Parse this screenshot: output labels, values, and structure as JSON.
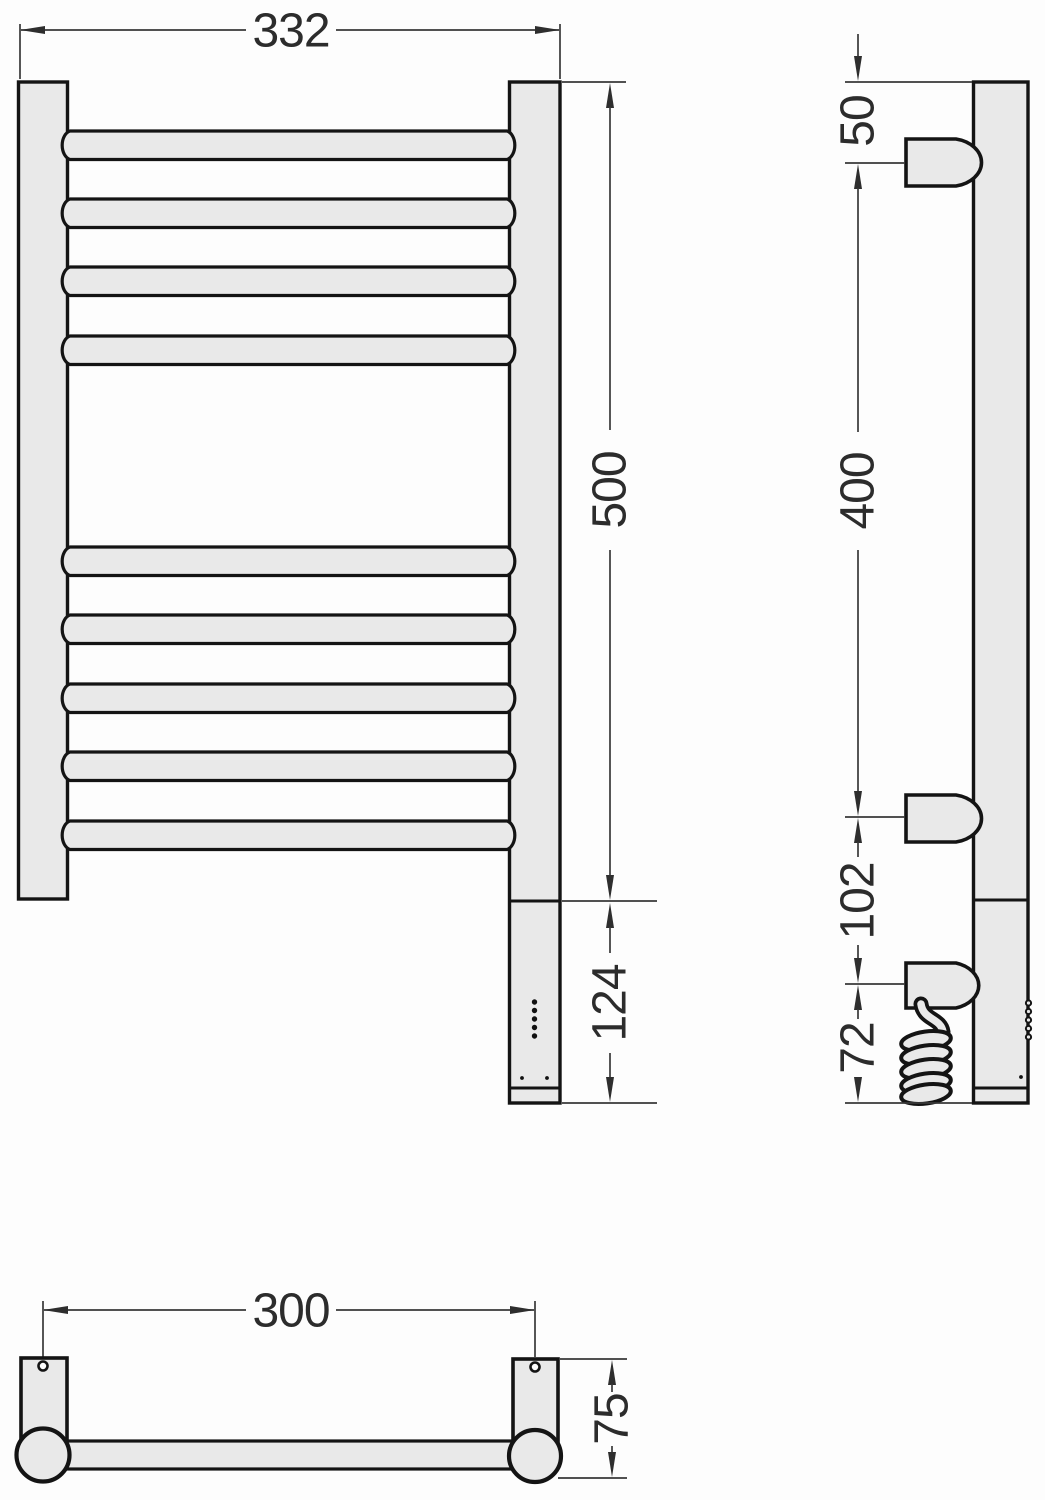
{
  "dimensions": {
    "front": {
      "overall_width": "332",
      "overall_height": "500",
      "heater_housing_height": "124"
    },
    "side": {
      "top_to_upper_bracket": "50",
      "upper_to_lower_bracket": "400",
      "lower_bracket_to_cable_unit": "102",
      "cable_unit_to_bottom": "72"
    },
    "bottom": {
      "mounting_hole_spacing": "300",
      "wall_depth": "75"
    }
  },
  "colors": {
    "part_fill": "#e9e9e9",
    "part_outline": "#141414",
    "dimension_line": "#383838",
    "dimension_text": "#2c2c2c",
    "background": "#fdfdfd"
  }
}
